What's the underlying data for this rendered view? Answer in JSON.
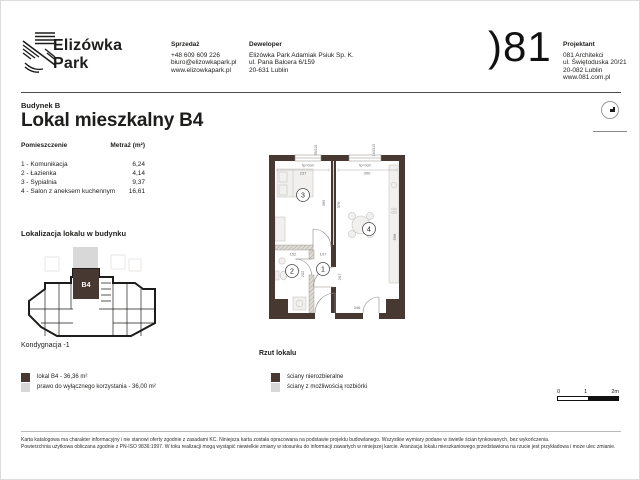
{
  "colors": {
    "accent_dark": "#473932",
    "light_gray": "#d8d8d8",
    "text": "#1d1d1b"
  },
  "header": {
    "brand": {
      "line1": "Elizówka",
      "line2": "Park"
    },
    "sales": {
      "label": "Sprzedaż",
      "phone": "+48 609 609 226",
      "email": "biuro@elizowkapark.pl",
      "www": "www.elizowkapark.pl"
    },
    "developer": {
      "label": "Deweloper",
      "name": "Elizówka Park Adamiak Psiuk Sp. K.",
      "address1": "ul. Pana Balcera 6/159",
      "address2": "20-631 Lublin"
    },
    "architect_logo": ")81",
    "designer": {
      "label": "Projektant",
      "name": "081 Architekci",
      "address1": "ul. Świętoduska 20/21",
      "address2": "20-082 Lublin",
      "www": "www.081.com.pl"
    }
  },
  "title": {
    "building": "Budynek B",
    "unit": "Lokal mieszkalny B4"
  },
  "rooms": {
    "col_name": "Pomieszczenie",
    "col_area": "Metraż (m²)",
    "items": [
      {
        "name": "1 - Komunikacja",
        "area": "6,24"
      },
      {
        "name": "2 - Łazienka",
        "area": "4,14"
      },
      {
        "name": "3 - Sypialnia",
        "area": "9,37"
      },
      {
        "name": "4 - Salon z aneksem kuchennym",
        "area": "16,61"
      }
    ]
  },
  "location": {
    "title": "Lokalizacja lokalu w budynku",
    "unit": "B4",
    "floor": "Kondygnacja -1"
  },
  "plan": {
    "label": "Rzut lokalu",
    "room_numbers": {
      "r1": "1",
      "r2": "2",
      "r3": "3",
      "r4": "4"
    },
    "dims": {
      "win_a": "95/215",
      "win_b": "140/215",
      "sill_a": "hp=0cm",
      "sill_b": "hp=0cm",
      "w3": "237",
      "w4": "300",
      "h3": "365",
      "h34": "376",
      "h4": "596",
      "w2": "152",
      "w1": "107",
      "h2": "202",
      "h1": "207",
      "wb": "346"
    }
  },
  "legend_left": {
    "items": [
      {
        "label": "lokal B4 - 36,36 m²",
        "color": "#473932"
      },
      {
        "label": "prawo do wyłącznego korzystania - 36,00 m²",
        "color": "#d8d8d8"
      }
    ]
  },
  "legend_right": {
    "items": [
      {
        "label": "ściany nierozbieralne",
        "color": "#473932"
      },
      {
        "label": "ściany z możliwością rozbiórki",
        "color": "#d8d8d8"
      }
    ]
  },
  "scalebar": {
    "t0": "0",
    "t1": "1",
    "t2": "2m"
  },
  "footer": {
    "line1": "Karta katalogowa ma charakter informacyjny i nie stanowi oferty zgodnie z zasadami KC. Niniejsza karta została opracowana na podstawie projektu budowlanego. Wszystkie wymiary podane w świetle ścian tynkowanych, bez wykończenia.",
    "line2": "Powierzchnia użytkowa obliczana zgodnie z PN-ISO 9836:1997. W toku realizacji mogą wystąpić niewielkie zmiany w stosunku do informacji zawartych w niniejszej karcie. Aranżacja lokalu mieszkaniowego przedstawiona na rzucie jest przykładowa i może ulec zmianie."
  }
}
